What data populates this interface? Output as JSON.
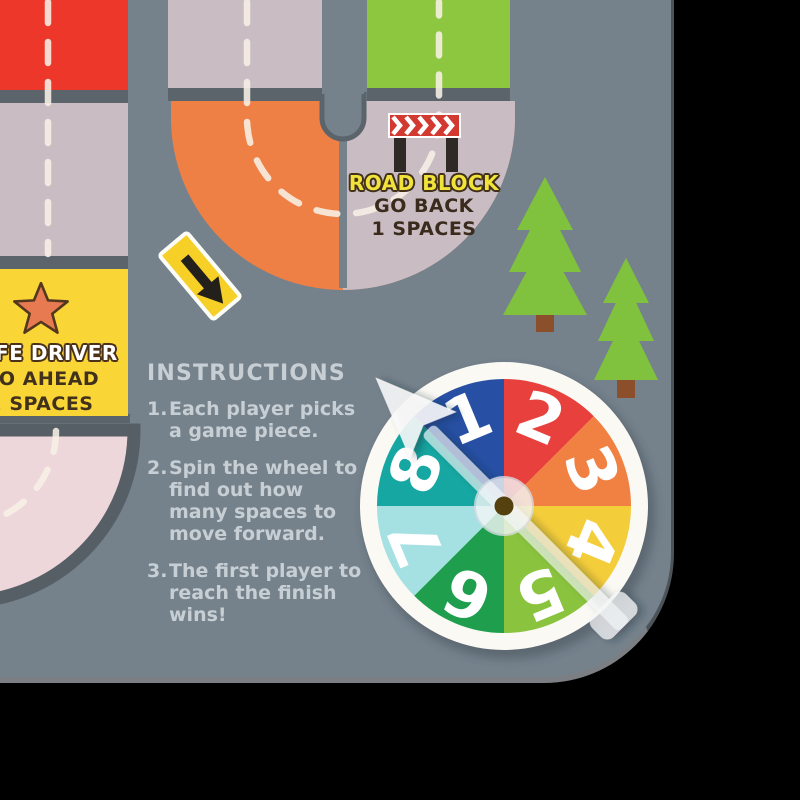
{
  "signs": {
    "roadblock": {
      "title": "ROAD BLOCK",
      "action": "GO BACK",
      "amount": "1 SPACES"
    },
    "safe_driver": {
      "title": "SAFE DRIVER",
      "action": "GO AHEAD",
      "amount": "2 SPACES"
    }
  },
  "instructions": {
    "heading": "INSTRUCTIONS",
    "items": [
      {
        "num": "1.",
        "lines": [
          "Each player picks",
          "a game piece."
        ]
      },
      {
        "num": "2.",
        "lines": [
          "Spin the wheel to",
          "find out how",
          "many spaces to",
          "move forward."
        ]
      },
      {
        "num": "3.",
        "lines": [
          "The first player to",
          "reach the finish",
          "wins!"
        ]
      }
    ]
  },
  "wheel": {
    "segments": [
      {
        "label": "1",
        "color": "#2750a4"
      },
      {
        "label": "2",
        "color": "#e8413d"
      },
      {
        "label": "3",
        "color": "#f08142"
      },
      {
        "label": "4",
        "color": "#f4cd3b"
      },
      {
        "label": "5",
        "color": "#8ac43e"
      },
      {
        "label": "6",
        "color": "#1f9e4d"
      },
      {
        "label": "7",
        "color": "#a5e0e2"
      },
      {
        "label": "8",
        "color": "#16a7a2"
      }
    ]
  },
  "colors": {
    "background": "#000000",
    "board": "#75828c",
    "road_gap": "#5c646b",
    "space_red": "#ee372b",
    "space_mauve": "#c9bdc3",
    "space_orange": "#ef8045",
    "space_green": "#8dc63f",
    "curve_pink": "#eed7db",
    "dash": "#f7f0e6",
    "card_yellow": "#f9d636",
    "star_orange": "#e87a52",
    "barrier_red": "#d23a31",
    "sign_yellow": "#f6cf27",
    "tree_green": "#80c23d",
    "trunk_brown": "#8c4f2b",
    "text_light": "#c7cfd4",
    "roadblock_yellow": "#f2e33c",
    "sign_text_dark": "#3a2b1d",
    "wheel_ring": "#fbf9f4"
  }
}
